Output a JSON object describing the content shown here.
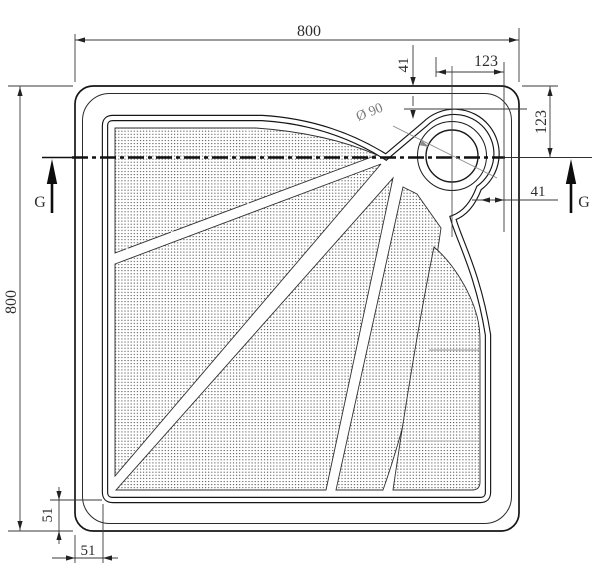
{
  "drawing": {
    "type": "technical-drawing",
    "subject": "Square shower tray - top view",
    "dimensions": {
      "top_width": "800",
      "left_height": "800",
      "top_drain_offset": "123",
      "right_drain_offset": "123",
      "top_drain_gap": "41",
      "right_drain_gap": "41",
      "left_floor_margin": "51",
      "bottom_floor_margin": "51",
      "drain_diameter": "Ø 90"
    },
    "section_markers": {
      "left": "G",
      "right": "G"
    },
    "colors": {
      "line": "#1b1b1b",
      "dimension": "#3a3a3a",
      "leader": "#8c8c8c",
      "texture_dot": "#3f3f3f",
      "background": "#ffffff"
    }
  }
}
